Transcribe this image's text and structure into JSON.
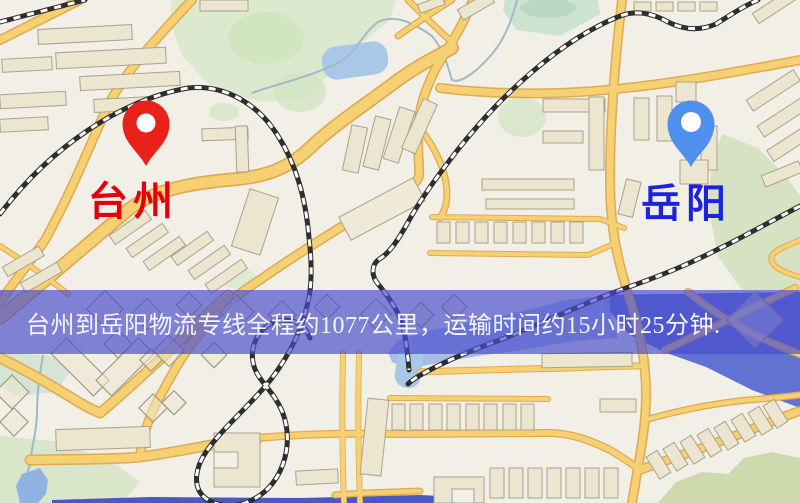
{
  "map": {
    "origin_label": "台州",
    "destination_label": "岳阳",
    "origin_color": "#e3000e",
    "destination_color": "#1d23dc",
    "origin_pin_color": "#e8211a",
    "destination_pin_color": "#4f8fee"
  },
  "banner": {
    "text": "台州到岳阳物流专线全程约1077公里，运输时间约15小时25分钟.",
    "background": "rgba(72,76,205,0.68)",
    "text_color": "#f4f4fb"
  }
}
